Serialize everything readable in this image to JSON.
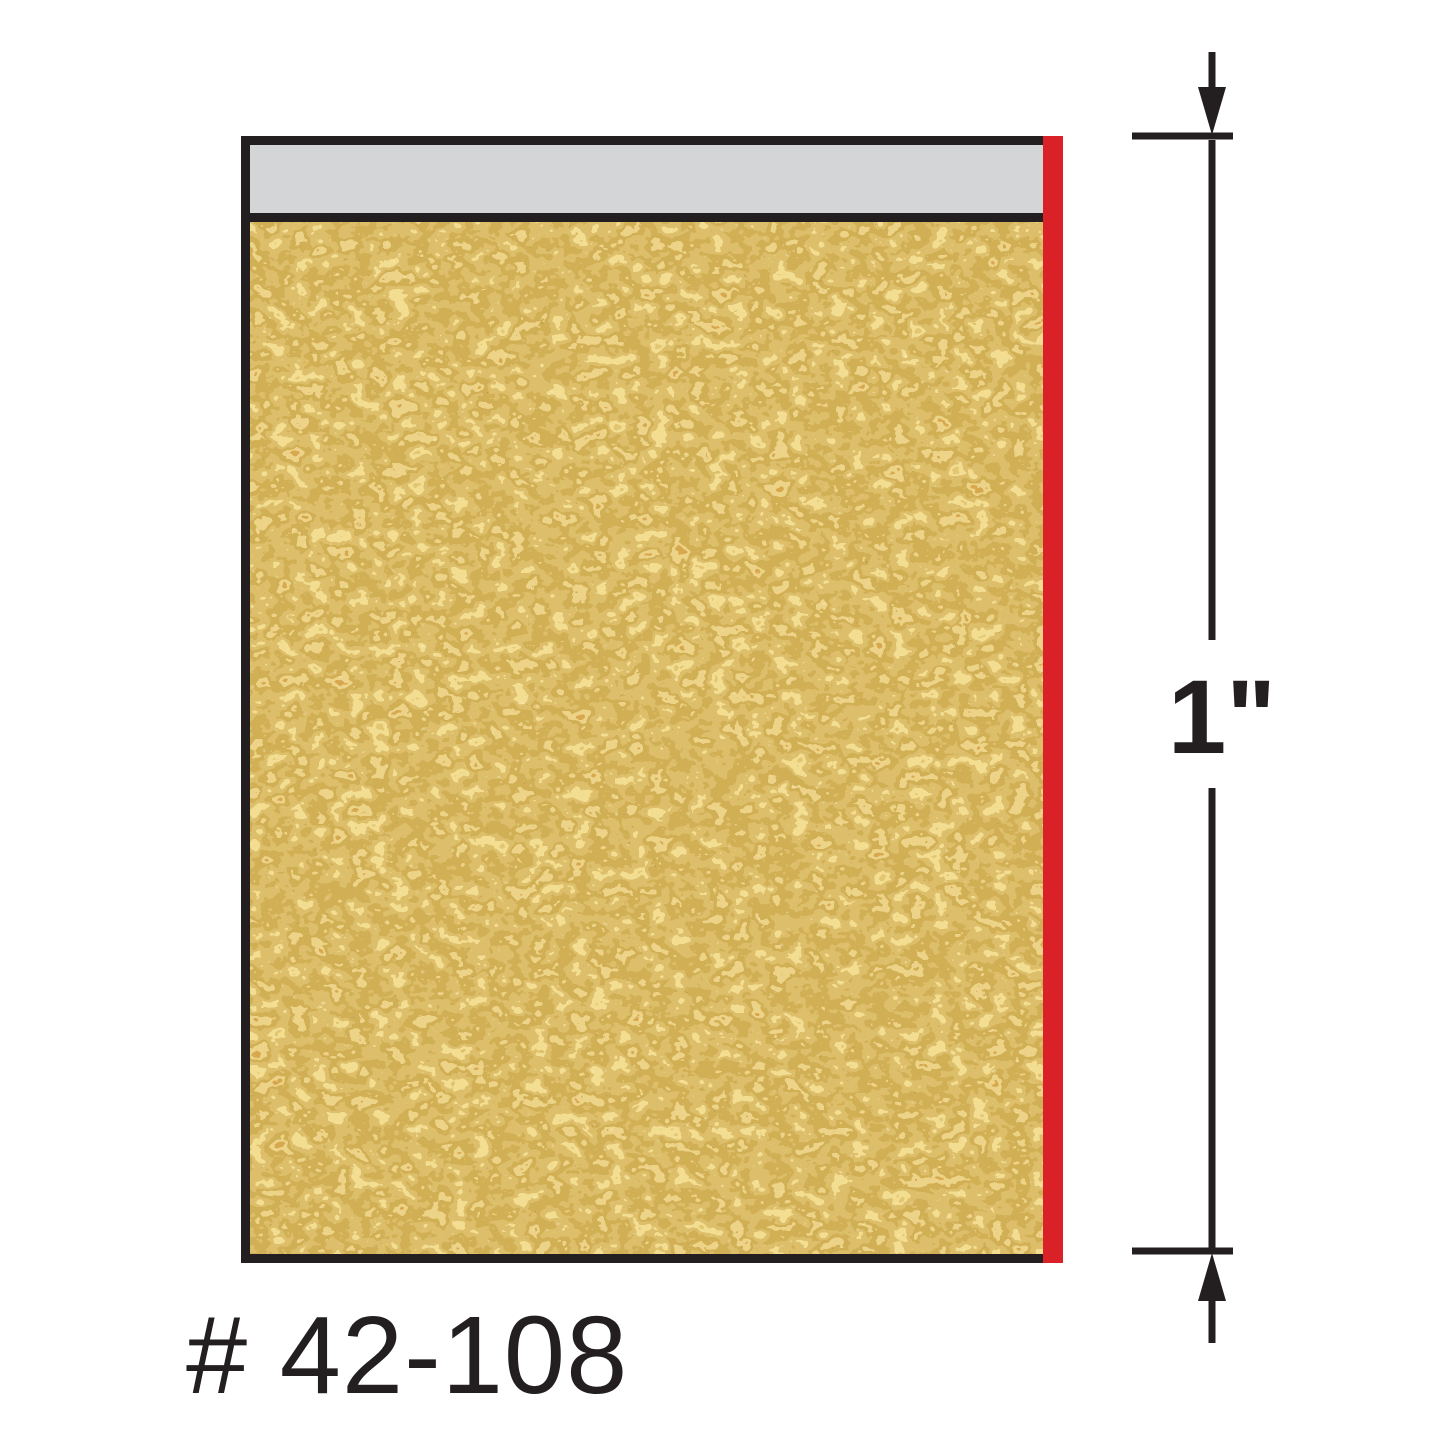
{
  "figure": {
    "part_number_label": "# 42-108",
    "dimension": {
      "label": "1\""
    },
    "colors": {
      "outline": "#231f20",
      "laminate_gray": "#d4d5d7",
      "edge_red": "#da2128",
      "particleboard_base": "#e8d07e",
      "background": "#ffffff"
    }
  }
}
